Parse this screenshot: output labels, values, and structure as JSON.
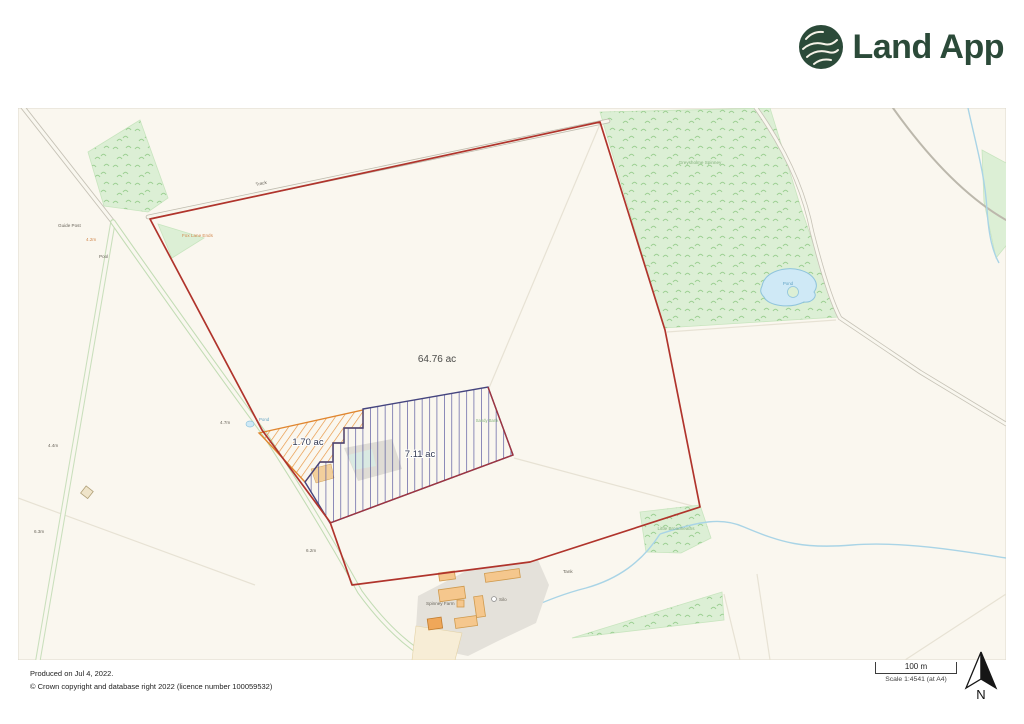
{
  "brand": {
    "name": "Land App"
  },
  "map": {
    "labels": {
      "track": "Track",
      "guide_post": "Guide Post",
      "fox_lane_ends": "Fox Lane Ends",
      "spot_fox": "4.2m",
      "pool": "Pool",
      "spot_a": "4.4m",
      "spot_b": "6.3m",
      "spot_c": "4.7m",
      "spot_d": "6.2m",
      "pond_small": "Pond",
      "greysholme": "Greysholme Spinney",
      "pond": "Pond",
      "sandy_bank": "Sandy Bank",
      "little_broadheaths": "Little Broadheaths",
      "tank": "Tank",
      "silo": "Silo",
      "spinney_farm": "Spinney Farm",
      "main_area": "64.76 ac",
      "orange_area": "1.70 ac",
      "blue_area": "7.11 ac"
    }
  },
  "footer": {
    "produced": "Produced on Jul 4, 2022.",
    "copyright": "© Crown copyright and database right 2022 (licence number 100059532)",
    "scale_label": "100 m",
    "scale_text": "Scale 1:4541 (at A4)",
    "north": "N"
  },
  "colors": {
    "boundary_red": "#b0342c",
    "plot_orange": "#e0862f",
    "plot_blue": "#44447e",
    "brand_green": "#2b4a39",
    "wood_green": "#dcefd5"
  }
}
